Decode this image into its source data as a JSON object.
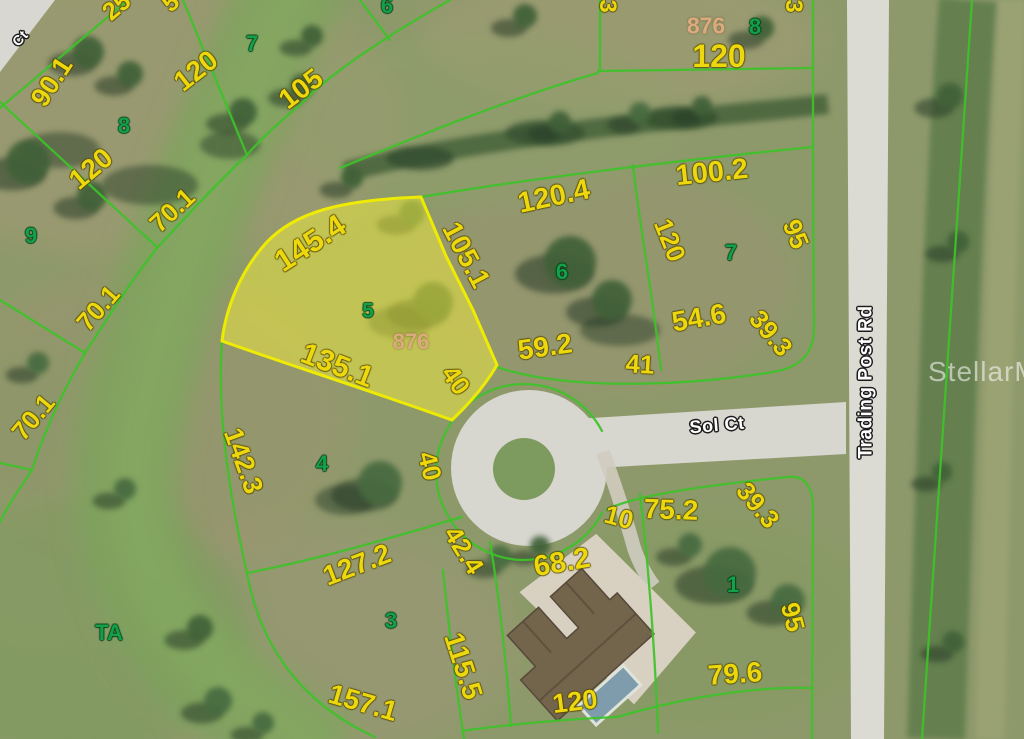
{
  "map": {
    "highlighted_lot": {
      "lot_number": "5",
      "parcel_id": "876"
    },
    "watermark": {
      "text": "StellarMLS"
    },
    "colors": {
      "dimension_text": "#edd70d",
      "lot_number_text": "#12a14a",
      "parcel_id_text": "#dcab7d",
      "lot_line": "#3ec229",
      "highlight_fill": "#f4ee3e",
      "highlight_stroke": "#f2ee00",
      "road": "#d7d6cf",
      "street_text": "#ffffff"
    },
    "dimension_labels": [
      {
        "text": "90.1",
        "x": 52,
        "y": 82,
        "rot": -57,
        "size": 27
      },
      {
        "text": "120",
        "x": 196,
        "y": 71,
        "rot": -38,
        "size": 28
      },
      {
        "text": "105",
        "x": 301,
        "y": 89,
        "rot": -37,
        "size": 28
      },
      {
        "text": "25",
        "x": 117,
        "y": 7,
        "rot": -40,
        "size": 25
      },
      {
        "text": "5",
        "x": 171,
        "y": 3,
        "rot": -40,
        "size": 25
      },
      {
        "text": "120",
        "x": 91,
        "y": 169,
        "rot": -40,
        "size": 28
      },
      {
        "text": "70.1",
        "x": 172,
        "y": 210,
        "rot": -43,
        "size": 26
      },
      {
        "text": "70.1",
        "x": 98,
        "y": 308,
        "rot": -49,
        "size": 26
      },
      {
        "text": "70.1",
        "x": 33,
        "y": 417,
        "rot": -50,
        "size": 26
      },
      {
        "text": "145.4",
        "x": 310,
        "y": 243,
        "rot": -33,
        "size": 31
      },
      {
        "text": "135.1",
        "x": 337,
        "y": 366,
        "rot": 21,
        "size": 30
      },
      {
        "text": "105.1",
        "x": 466,
        "y": 255,
        "rot": 62,
        "size": 28
      },
      {
        "text": "40",
        "x": 456,
        "y": 380,
        "rot": 55,
        "size": 26
      },
      {
        "text": "40",
        "x": 430,
        "y": 466,
        "rot": 76,
        "size": 26
      },
      {
        "text": "120.4",
        "x": 554,
        "y": 197,
        "rot": -12,
        "size": 29
      },
      {
        "text": "100.2",
        "x": 712,
        "y": 173,
        "rot": -6,
        "size": 29
      },
      {
        "text": "120",
        "x": 670,
        "y": 240,
        "rot": 68,
        "size": 26
      },
      {
        "text": "95",
        "x": 796,
        "y": 234,
        "rot": 68,
        "size": 26
      },
      {
        "text": "54.6",
        "x": 699,
        "y": 318,
        "rot": -10,
        "size": 28
      },
      {
        "text": "59.2",
        "x": 545,
        "y": 347,
        "rot": -8,
        "size": 28
      },
      {
        "text": "41",
        "x": 640,
        "y": 364,
        "rot": 3,
        "size": 26
      },
      {
        "text": "39.3",
        "x": 771,
        "y": 333,
        "rot": 50,
        "size": 26
      },
      {
        "text": "39.3",
        "x": 758,
        "y": 505,
        "rot": 50,
        "size": 26
      },
      {
        "text": "10",
        "x": 619,
        "y": 517,
        "rot": 15,
        "size": 26
      },
      {
        "text": "75.2",
        "x": 671,
        "y": 510,
        "rot": 2,
        "size": 28
      },
      {
        "text": "42.4",
        "x": 464,
        "y": 550,
        "rot": 58,
        "size": 26
      },
      {
        "text": "68.2",
        "x": 562,
        "y": 563,
        "rot": -10,
        "size": 29
      },
      {
        "text": "142.3",
        "x": 243,
        "y": 461,
        "rot": 70,
        "size": 27
      },
      {
        "text": "127.2",
        "x": 357,
        "y": 565,
        "rot": -21,
        "size": 28
      },
      {
        "text": "115.5",
        "x": 463,
        "y": 666,
        "rot": 72,
        "size": 28
      },
      {
        "text": "157.1",
        "x": 363,
        "y": 703,
        "rot": 16,
        "size": 28
      },
      {
        "text": "120",
        "x": 575,
        "y": 702,
        "rot": -7,
        "size": 27
      },
      {
        "text": "79.6",
        "x": 735,
        "y": 674,
        "rot": -4,
        "size": 28
      },
      {
        "text": "95",
        "x": 793,
        "y": 617,
        "rot": 75,
        "size": 26
      },
      {
        "text": "120",
        "x": 719,
        "y": 56,
        "rot": 0,
        "size": 32
      },
      {
        "text": "3",
        "x": 607,
        "y": 6,
        "rot": 90,
        "size": 24
      },
      {
        "text": "3",
        "x": 793,
        "y": 6,
        "rot": 90,
        "size": 24
      }
    ],
    "lot_numbers": [
      {
        "text": "9",
        "x": 31,
        "y": 236
      },
      {
        "text": "8",
        "x": 124,
        "y": 126
      },
      {
        "text": "7",
        "x": 252,
        "y": 44
      },
      {
        "text": "6",
        "x": 387,
        "y": 6
      },
      {
        "text": "6",
        "x": 562,
        "y": 272
      },
      {
        "text": "7",
        "x": 731,
        "y": 253
      },
      {
        "text": "8",
        "x": 755,
        "y": 27
      },
      {
        "text": "5",
        "x": 368,
        "y": 311,
        "size": 21
      },
      {
        "text": "4",
        "x": 322,
        "y": 464
      },
      {
        "text": "3",
        "x": 391,
        "y": 621
      },
      {
        "text": "1",
        "x": 733,
        "y": 585
      },
      {
        "text": "TA",
        "x": 109,
        "y": 633
      }
    ],
    "parcel_ids": [
      {
        "text": "876",
        "x": 706,
        "y": 26,
        "size": 23
      },
      {
        "text": "876",
        "x": 411,
        "y": 342,
        "size": 22
      }
    ],
    "street_labels": [
      {
        "text": "Sol Ct",
        "x": 717,
        "y": 425,
        "rot": -5,
        "size": 18
      },
      {
        "text": "Trading Post Rd",
        "x": 866,
        "y": 382,
        "rot": -90,
        "size": 19
      },
      {
        "text": "Ct",
        "x": 20,
        "y": 38,
        "rot": -48,
        "size": 14
      }
    ]
  }
}
